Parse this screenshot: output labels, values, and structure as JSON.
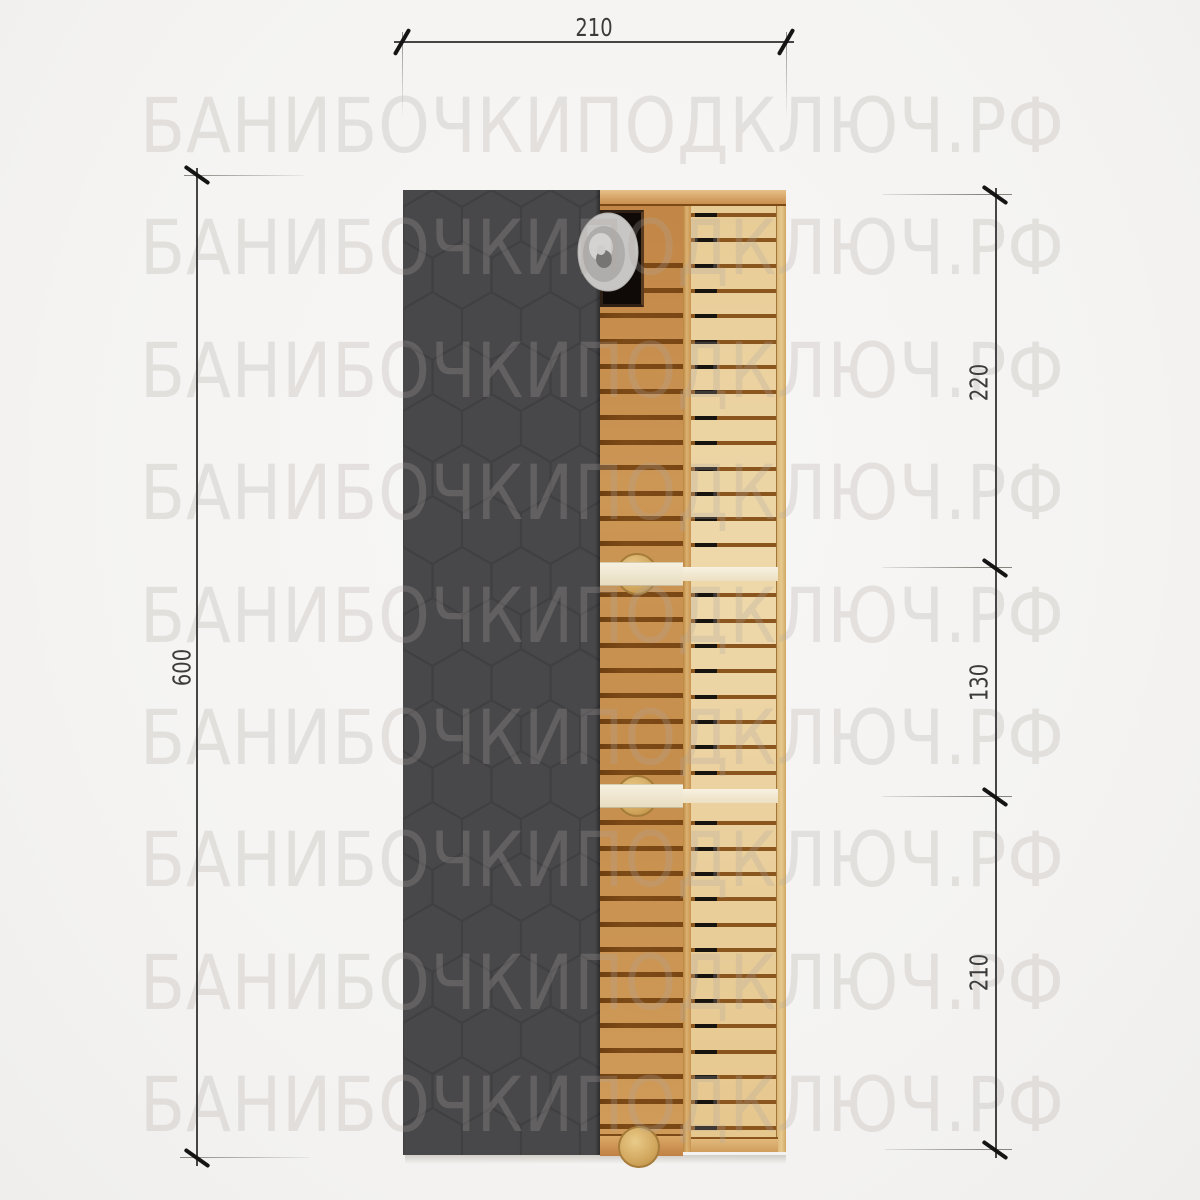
{
  "page": {
    "background": "#f5f4f2",
    "description": "Top view technical drawing of a barrel sauna"
  },
  "watermark": {
    "text": "БАНИБОЧКИПОДКЛЮЧ.РФ",
    "color": "rgba(172,168,162,0.26)",
    "rows": 9,
    "left": 140,
    "top": 88,
    "pitch": 122.4,
    "target_width": 925,
    "font_size": 76
  },
  "dimensions": {
    "top": {
      "label": "210"
    },
    "left": {
      "label": "600"
    },
    "right": {
      "segments": [
        {
          "label": "220"
        },
        {
          "label": "130"
        },
        {
          "label": "210"
        }
      ]
    }
  },
  "drawing": {
    "colors": {
      "roof": "#48484a",
      "roof_hex_line": "#3f3f41",
      "wood_mid": "#c9924f",
      "wood_light": "#e9d09c",
      "gap_mid": "#7c4a16",
      "gap_right": "#8a561e",
      "gap_dash": "#17130e",
      "stove": "#0f0a07",
      "chimney": "#c7c6c4",
      "partition": "#f4eedc",
      "knob": "#d5ab61",
      "dimension": "#3b3b3b"
    },
    "mid_gaps": {
      "x": 600,
      "width": 83,
      "start": 265,
      "end": 1131,
      "pitch": 25.35,
      "height": 5
    },
    "right_gaps": {
      "x": 691,
      "width": 85,
      "start": 215,
      "end": 1128,
      "pitch": 25.35,
      "height": 4,
      "dash_left": 4,
      "dash_width": 22
    },
    "skip_bands": [
      [
        556,
        592
      ],
      [
        778,
        814
      ]
    ]
  }
}
